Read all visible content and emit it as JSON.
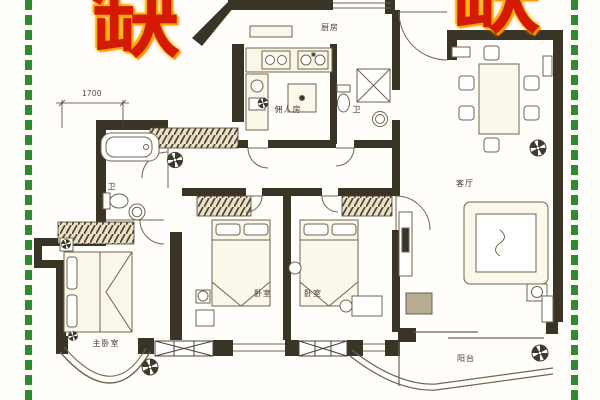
{
  "watermarks": {
    "top_left": "缺",
    "top_right": "缺"
  },
  "floorplan": {
    "dimension_label": "1700",
    "rooms": {
      "kitchen": "厨房",
      "maid_room": "佣人房",
      "bathroom_top": "卫",
      "bathroom_left": "卫",
      "bedroom_center_left": "卧室",
      "bedroom_center_right": "卧室",
      "master_bedroom": "主卧室",
      "living_room": "客厅",
      "balcony": "阳台"
    }
  },
  "icons": {
    "ceiling_fan": "pinwheel-fan-icon",
    "flower": "flower-icon"
  },
  "colors": {
    "watermark_red": "#d41a02",
    "watermark_glow": "#ffa000",
    "frame_green": "#2e8b2e",
    "wall_dark": "#3a3427",
    "line_olive": "#6f664f",
    "hatch_tone": "#4a4233",
    "accent_gray_block": "#b5ac92",
    "paper": "#fffefb"
  }
}
